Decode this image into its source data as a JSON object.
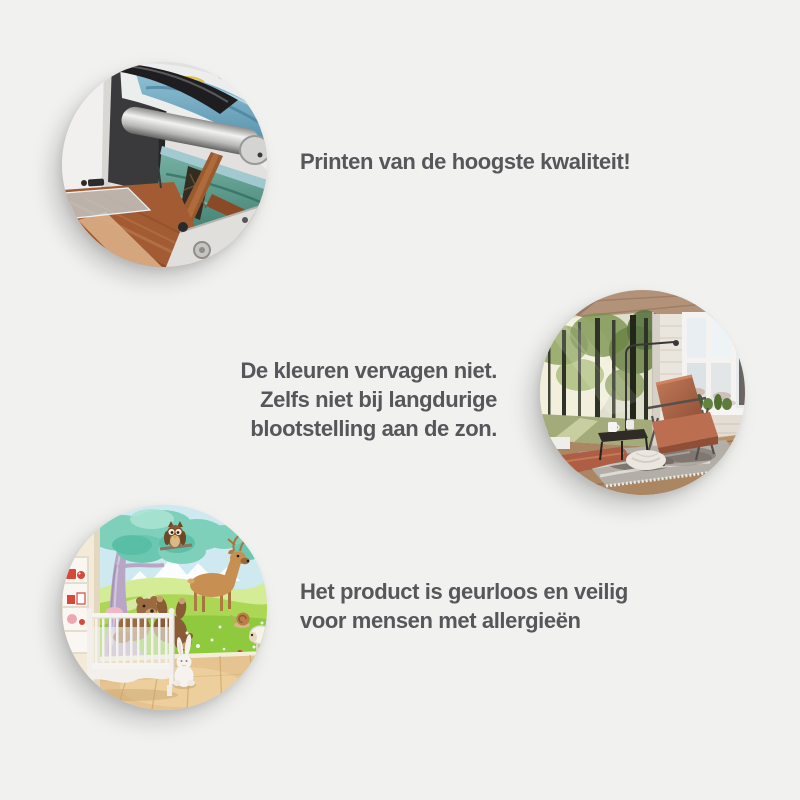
{
  "page": {
    "background_color": "#f1f1ef",
    "text_color": "#57575b"
  },
  "features": [
    {
      "image": "printing-machine-photo",
      "image_subject": "large format printer printing a colorful wall mural",
      "lines": [
        "Printen van de hoogste kwaliteit!"
      ]
    },
    {
      "image": "living-room-forest-mural-photo",
      "image_subject": "interior with forest photo wallpaper, leather chair and window",
      "lines": [
        "De kleuren vervagen niet.",
        "Zelfs niet bij langdurige",
        "blootstelling aan de zon."
      ]
    },
    {
      "image": "nursery-animal-mural-photo",
      "image_subject": "nursery with white crib and cartoon animal wall mural",
      "lines": [
        "Het product is geurloos en veilig",
        "voor mensen met allergieën"
      ]
    }
  ]
}
